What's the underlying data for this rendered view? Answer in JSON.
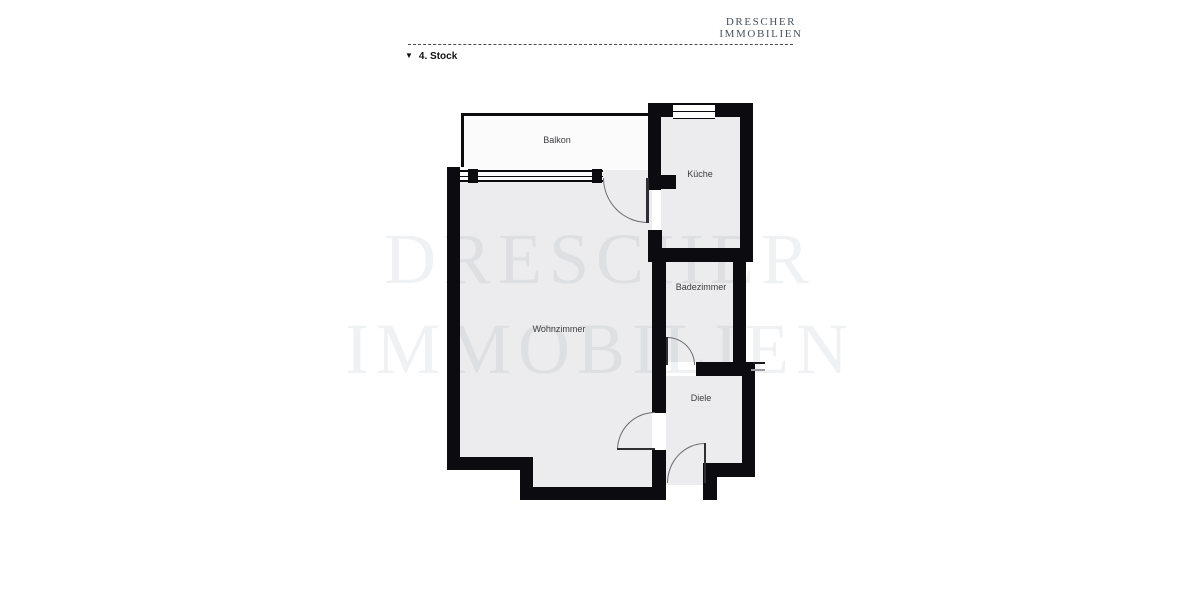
{
  "brand": {
    "line1": "DRESCHER",
    "line2": "IMMOBILIEN"
  },
  "floor": {
    "marker": "▼",
    "label": "4. Stock"
  },
  "watermark": {
    "line1": "DRESCHER",
    "line2": "IMMOBILIEN"
  },
  "rooms": {
    "balkon": "Balkon",
    "kueche": "Küche",
    "badezimmer": "Badezimmer",
    "wohnzimmer": "Wohnzimmer",
    "diele": "Diele"
  },
  "colors": {
    "wall": "#0c0c10",
    "room_fill": "#ececee",
    "balcony_fill": "#fbfbfc",
    "watermark_tint": "rgba(70,78,96,0.08)",
    "brand_text": "#49525a",
    "door_line": "#6a6b70"
  }
}
